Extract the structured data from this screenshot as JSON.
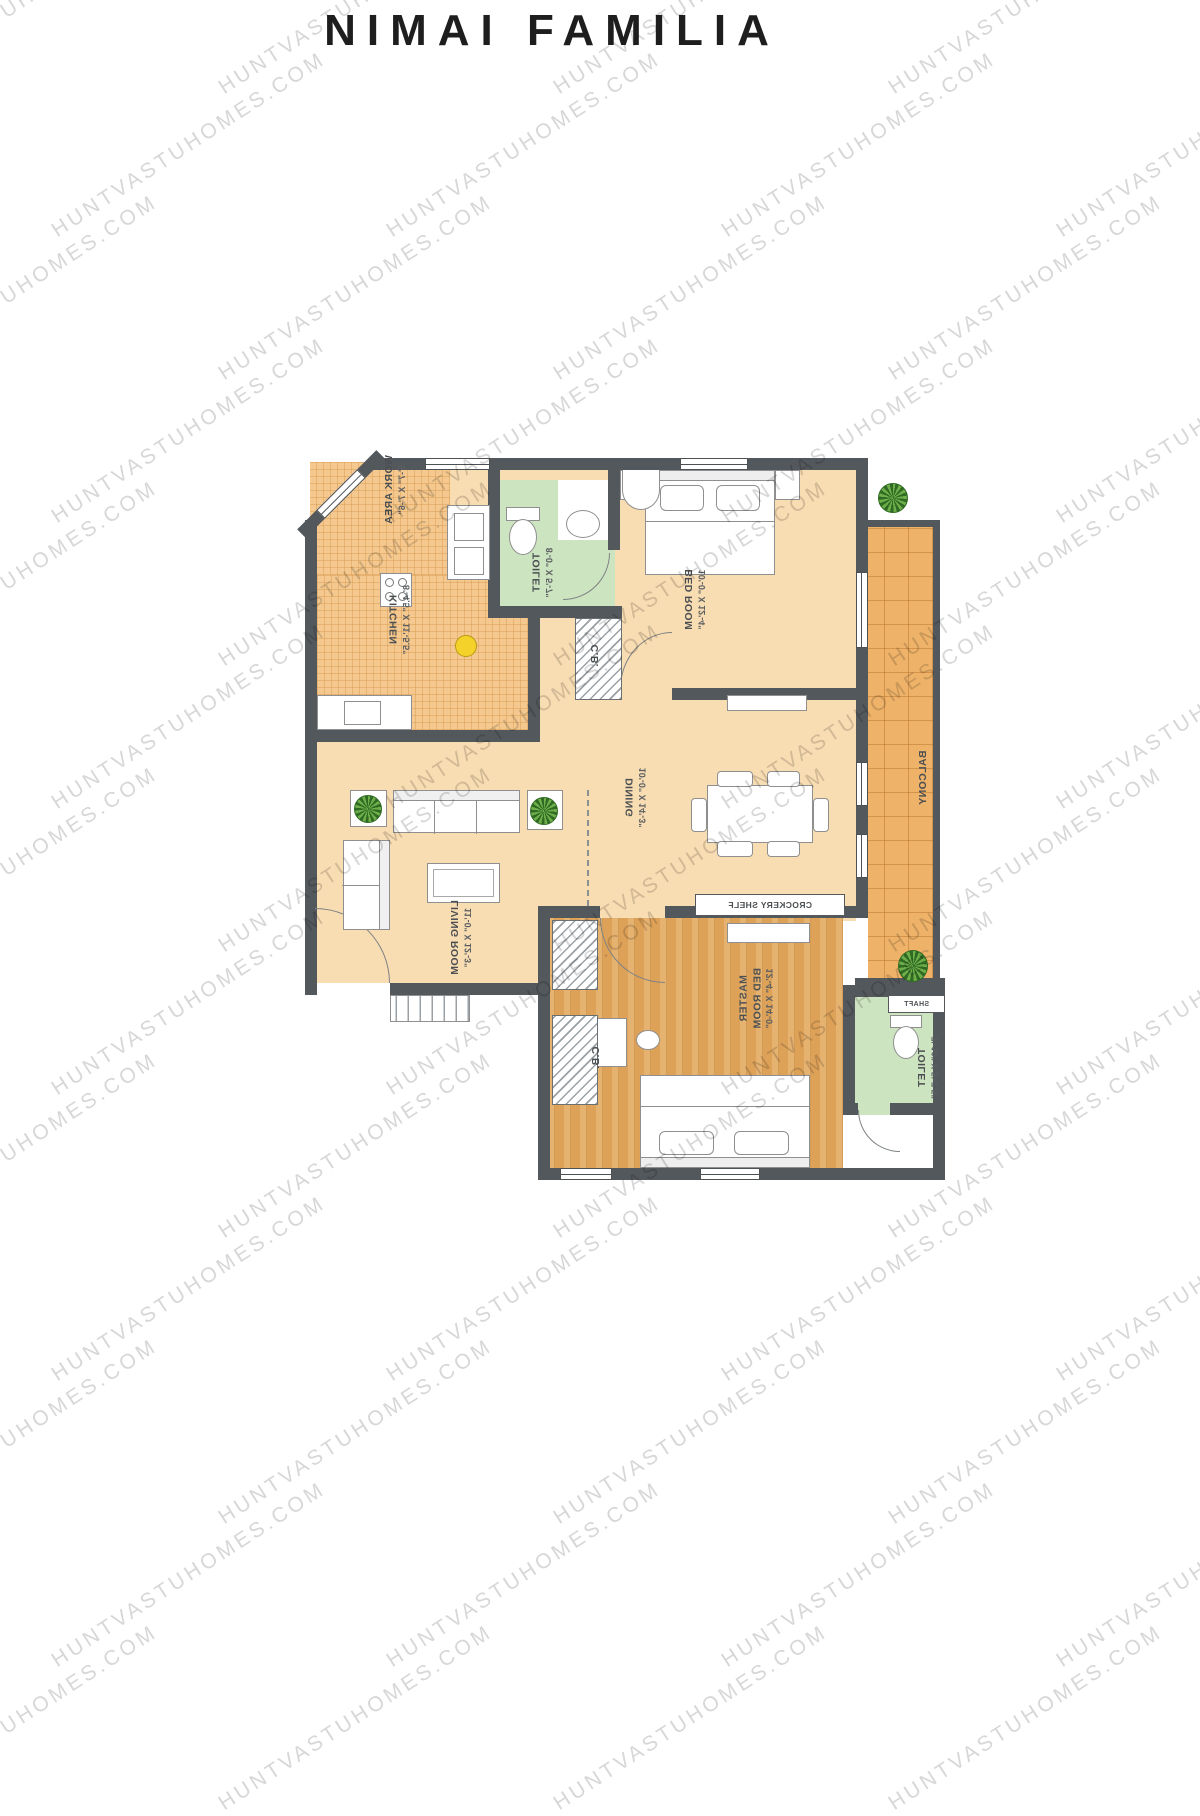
{
  "title": "NIMAI FAMILIA",
  "watermark": {
    "text": "HUNTVASTUHOMES.COM"
  },
  "colors": {
    "walls": "#53585c",
    "floor_cream": "#f8dcb2",
    "floor_kitchen": "#f4c88e",
    "floor_balcony": "#eeb268",
    "floor_toilet": "#cde4c0",
    "floor_wood": "#dda158"
  },
  "rooms": {
    "work_area": {
      "name": "WORK AREA",
      "dims": "5'-7\" X 7'-6\""
    },
    "toilet_top": {
      "name": "TOILET",
      "dims": "8'-0\" X 5'-7\""
    },
    "kitchen": {
      "name": "KITCHEN",
      "dims": "8'-4.5\" X 11'-5.5\""
    },
    "cb_top": {
      "name": "C.B."
    },
    "bedroom": {
      "name": "BED ROOM",
      "dims": "10'-0\" X 12'-4\""
    },
    "balcony": {
      "name": "BALCONY"
    },
    "dining": {
      "name": "DINING",
      "dims": "10'-0\" X 14'-3\""
    },
    "living": {
      "name": "LIVING ROOM",
      "dims": "11'-0\" X 12'-3\""
    },
    "crockery": {
      "name": "CROCKERY SHELF"
    },
    "master": {
      "name": "MASTER BED ROOM",
      "dims": "12'-4\" X 14'-0\""
    },
    "cb_master": {
      "name": "C.B."
    },
    "toilet_master": {
      "name": "TOILET",
      "dims": "7'-10\" X 5'-7.5\""
    },
    "shaft": {
      "name": "SHAFT"
    }
  }
}
